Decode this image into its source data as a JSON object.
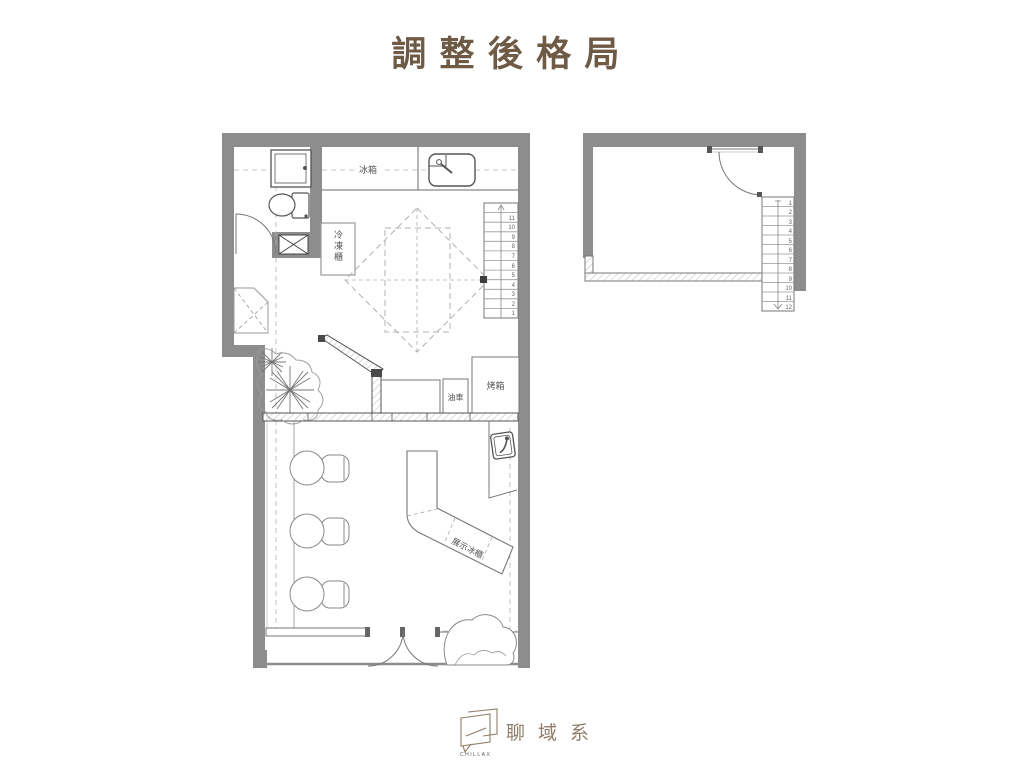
{
  "title": {
    "text": "調整後格局"
  },
  "colors": {
    "title-color": "#6f5b45",
    "logo-color": "#8e7d69",
    "wall-gray": "#8d8d8d",
    "line-dark": "#4f4f4f",
    "hatch": "#c9c4bd"
  },
  "main_plan": {
    "labels": {
      "fridge": "冰箱",
      "freezer": "冷凍櫃",
      "cart": "油車",
      "oven": "烤箱",
      "display_fridge": "展示冰櫃"
    },
    "stairs": {
      "numbers": [
        "1",
        "2",
        "3",
        "4",
        "5",
        "6",
        "7",
        "8",
        "9",
        "10",
        "11"
      ]
    }
  },
  "upper_plan": {
    "stairs": {
      "numbers": [
        "1",
        "2",
        "3",
        "4",
        "5",
        "6",
        "7",
        "8",
        "9",
        "10",
        "11",
        "12"
      ]
    }
  },
  "logo": {
    "cn": "聊域系",
    "en": "CHILLAX"
  }
}
